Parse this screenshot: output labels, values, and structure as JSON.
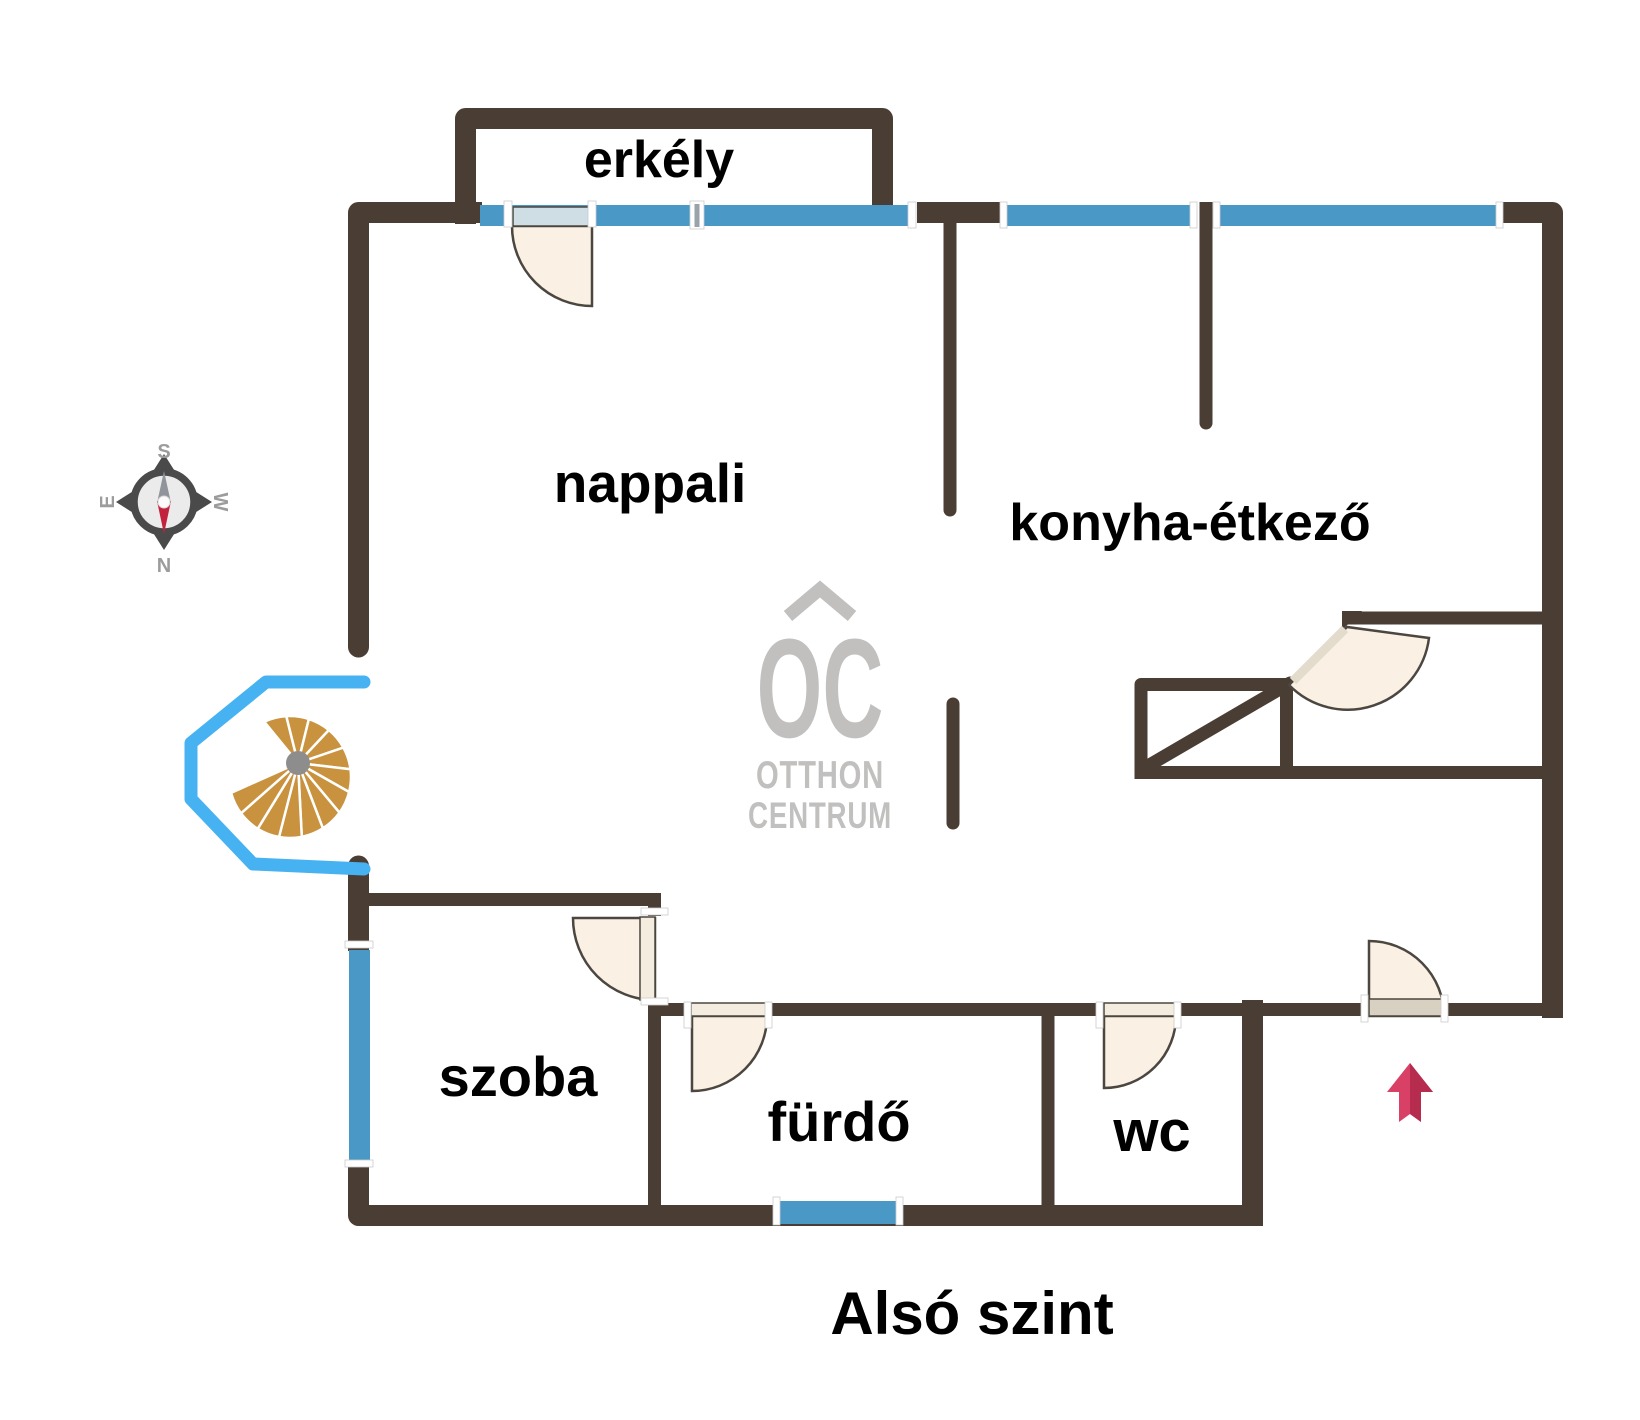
{
  "level_label": "Alsó szint",
  "rooms": [
    {
      "name": "erkély"
    },
    {
      "name": "nappali"
    },
    {
      "name": "konyha-étkező"
    },
    {
      "name": "szoba"
    },
    {
      "name": "fürdő"
    },
    {
      "name": "wc"
    }
  ],
  "watermark": {
    "monogram": "OC",
    "line1": "OTTHON",
    "line2": "CENTRUM"
  },
  "compass": {
    "north": "N",
    "south": "S",
    "east": "E",
    "west": "W"
  },
  "colors": {
    "wall": "#4a3d34",
    "window": "#4a98c5",
    "bay_window": "#47b2f2",
    "stair_tread": "#c9923e",
    "stair_hub": "#8d8d8d",
    "door_fill": "#faf1e4",
    "door_stroke": "#4b463f",
    "door_leaf_glass": "#cfdde4",
    "entry_arrow": "#d84165",
    "entry_arrow_shade": "#b52c4f",
    "watermark": "#c1c0bf",
    "compass_dark": "#4a4a4a",
    "compass_face": "#ebebeb",
    "compass_needle_red": "#c2223e",
    "compass_needle_gray": "#8f959b",
    "compass_letters": "#9c9c9c",
    "label": "#000000"
  }
}
